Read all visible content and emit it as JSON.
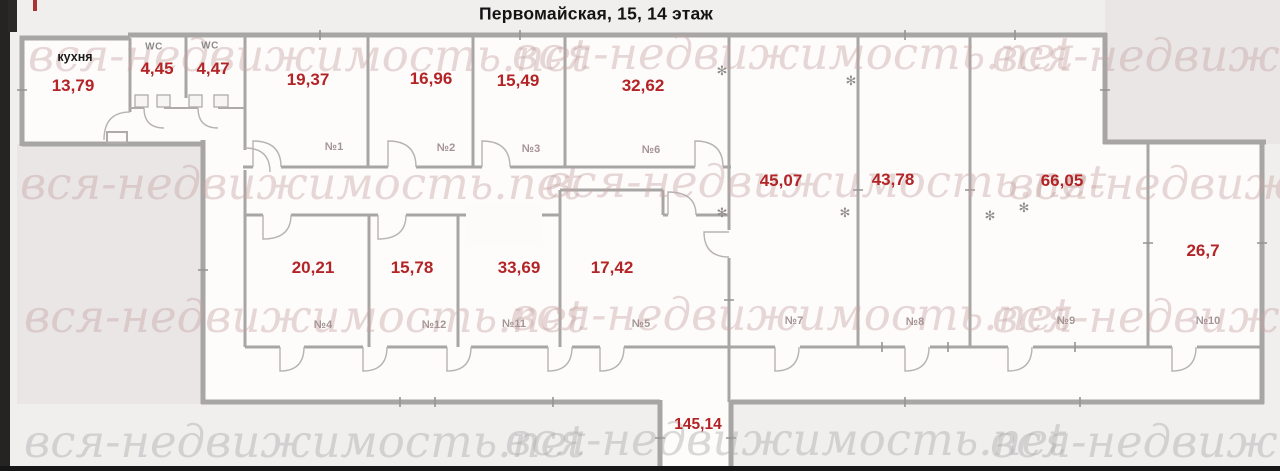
{
  "title": "Первомайская, 15, 14 этаж",
  "watermark": {
    "text": "вся-недвижимость.net"
  },
  "rooms": {
    "kitchen": {
      "name": "кухня",
      "area": "13,79"
    },
    "wc1": {
      "name": "WC",
      "area": "4,45"
    },
    "wc2": {
      "name": "WC",
      "area": "4,47"
    },
    "r1": {
      "number": "№1",
      "area": "19,37"
    },
    "r2": {
      "number": "№2",
      "area": "16,96"
    },
    "r3": {
      "number": "№3",
      "area": "15,49"
    },
    "r6": {
      "number": "№6",
      "area": "32,62"
    },
    "r7": {
      "number": "№7",
      "area": "45,07"
    },
    "r8": {
      "number": "№8",
      "area": "43,78"
    },
    "r9": {
      "number": "№9",
      "area": "66,05"
    },
    "r10": {
      "number": "№10",
      "area": "26,7"
    },
    "r4": {
      "number": "№4",
      "area": "20,21"
    },
    "r12": {
      "number": "№12",
      "area": "15,78"
    },
    "r11": {
      "number": "№11",
      "area": "33,69"
    },
    "r5": {
      "number": "№5",
      "area": "17,42"
    },
    "corridor": {
      "area": "145,14"
    }
  },
  "colors": {
    "area_label": "#b32427",
    "room_number": "#a59493",
    "walls": "#a8a6a4",
    "watermark": "#d9cbca",
    "border_strip": "#1c1a19"
  }
}
